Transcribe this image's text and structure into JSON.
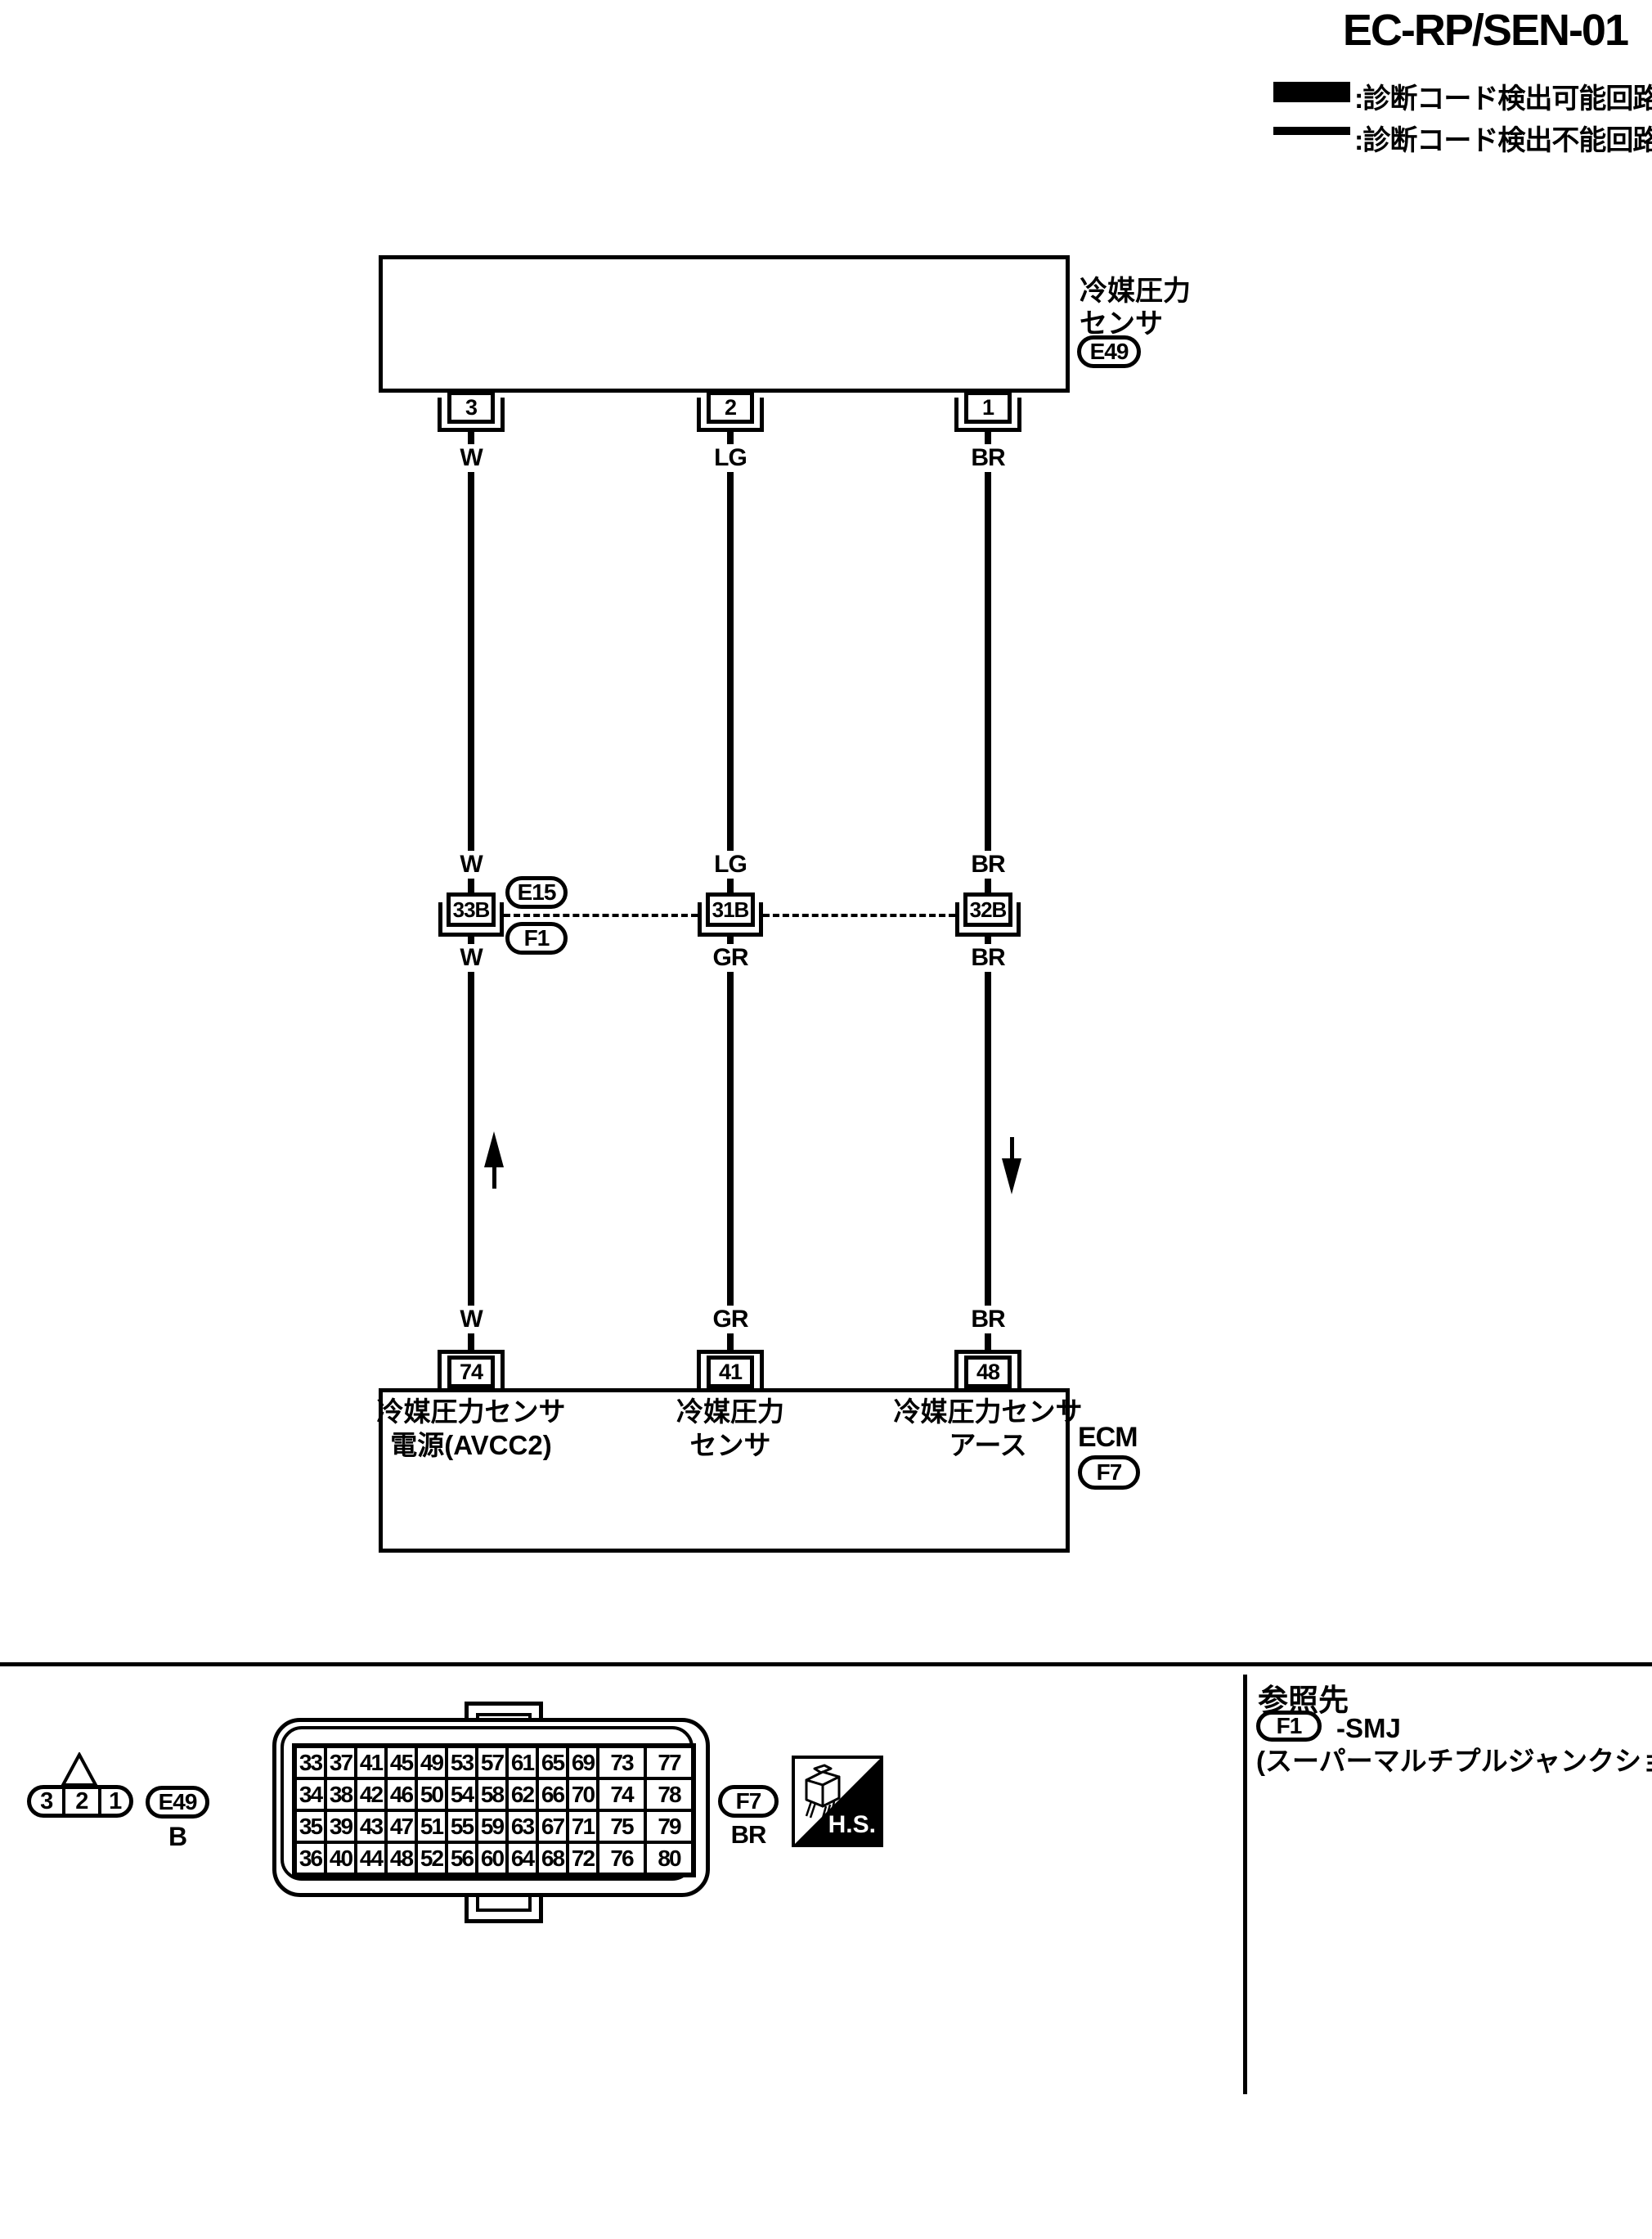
{
  "page": {
    "title": "EC-RP/SEN-01"
  },
  "legend": {
    "items": [
      {
        "style": "thick",
        "label": ":診断コード検出可能回路"
      },
      {
        "style": "thin",
        "label": ":診断コード検出不能回路"
      }
    ]
  },
  "sensor": {
    "name_line1": "冷媒圧力",
    "name_line2": "センサ",
    "code": "E49",
    "pins": [
      {
        "pin": "3",
        "wire": "W"
      },
      {
        "pin": "2",
        "wire": "LG"
      },
      {
        "pin": "1",
        "wire": "BR"
      }
    ]
  },
  "junction": {
    "codes": [
      "E15",
      "F1"
    ],
    "points": [
      {
        "pin": "33B",
        "wire_above": "W",
        "wire_below": "W"
      },
      {
        "pin": "31B",
        "wire_above": "LG",
        "wire_below": "GR"
      },
      {
        "pin": "32B",
        "wire_above": "BR",
        "wire_below": "BR"
      }
    ]
  },
  "ecm": {
    "name": "ECM",
    "code": "F7",
    "pins": [
      {
        "pin": "74",
        "wire": "W",
        "label_line1": "冷媒圧力センサ",
        "label_line2": "電源(AVCC2)"
      },
      {
        "pin": "41",
        "wire": "GR",
        "label_line1": "冷媒圧力",
        "label_line2": "センサ"
      },
      {
        "pin": "48",
        "wire": "BR",
        "label_line1": "冷媒圧力センサ",
        "label_line2": "アース"
      }
    ]
  },
  "footer": {
    "e49_view": {
      "pins": [
        "3",
        "2",
        "1"
      ],
      "code": "E49",
      "color": "B"
    },
    "f7_view": {
      "code": "F7",
      "color": "BR",
      "rows": [
        [
          "33",
          "37",
          "41",
          "45",
          "49",
          "53",
          "57",
          "61",
          "65",
          "69",
          "73",
          "77"
        ],
        [
          "34",
          "38",
          "42",
          "46",
          "50",
          "54",
          "58",
          "62",
          "66",
          "70",
          "74",
          "78"
        ],
        [
          "35",
          "39",
          "43",
          "47",
          "51",
          "55",
          "59",
          "63",
          "67",
          "71",
          "75",
          "79"
        ],
        [
          "36",
          "40",
          "44",
          "48",
          "52",
          "56",
          "60",
          "64",
          "68",
          "72",
          "76",
          "80"
        ]
      ]
    },
    "hs_label": "H.S.",
    "reference": {
      "heading": "参照先",
      "code": "F1",
      "target": "-SMJ",
      "note": "(スーパーマルチプルジャンクション)"
    }
  },
  "colors": {
    "ink": "#000000",
    "paper": "#ffffff"
  }
}
